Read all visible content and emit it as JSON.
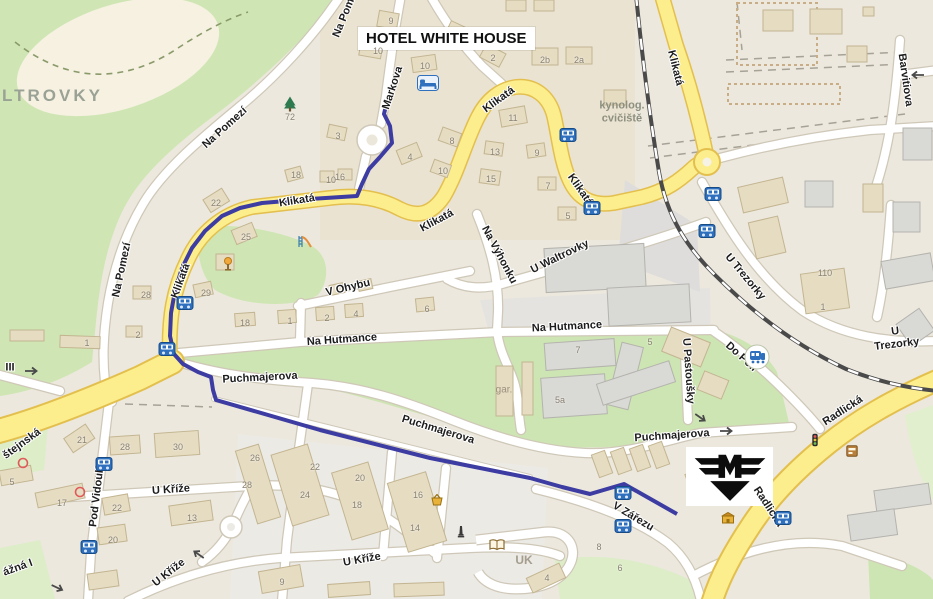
{
  "hotel": {
    "label": "HOTEL WHITE HOUSE"
  },
  "district_label": "LTROVKY",
  "logo": {
    "letter": "M",
    "name": "m-company-logo"
  },
  "colors": {
    "route": "#3c3ca2",
    "main_road_fill": "#fcee8d",
    "main_road_casing": "#e3bf4e",
    "minor_road_fill": "#ffffff",
    "minor_road_casing": "#cfc8b8",
    "green_area": "#cde5b2",
    "pale_green": "#dcedc8",
    "building_tan": "#e6dcc2",
    "building_gray": "#dbdad5",
    "railway_dark": "#4a4a4a",
    "bus_icon_blue": "#2e6fbe",
    "background": "#ece8dd"
  },
  "route": {
    "color": "#3c3ca2",
    "points": [
      [
        388,
        97
      ],
      [
        384,
        114
      ],
      [
        390,
        126
      ],
      [
        392,
        143
      ],
      [
        380,
        157
      ],
      [
        369,
        169
      ],
      [
        362,
        184
      ],
      [
        357,
        196
      ],
      [
        310,
        199
      ],
      [
        262,
        203
      ],
      [
        240,
        208
      ],
      [
        222,
        216
      ],
      [
        205,
        231
      ],
      [
        192,
        248
      ],
      [
        182,
        268
      ],
      [
        175,
        291
      ],
      [
        171,
        313
      ],
      [
        170,
        336
      ],
      [
        174,
        354
      ],
      [
        183,
        364
      ],
      [
        198,
        372
      ],
      [
        211,
        377
      ],
      [
        213,
        390
      ],
      [
        216,
        400
      ],
      [
        320,
        430
      ],
      [
        430,
        458
      ],
      [
        530,
        478
      ],
      [
        562,
        487
      ],
      [
        590,
        494
      ],
      [
        624,
        484
      ],
      [
        677,
        514
      ]
    ]
  },
  "street_labels": [
    {
      "t": "Na Pom",
      "x": 344,
      "y": 18,
      "rot": -68
    },
    {
      "t": "Na Pomezí",
      "x": 225,
      "y": 128,
      "rot": -42
    },
    {
      "t": "Na Pomezí",
      "x": 122,
      "y": 270,
      "rot": -78
    },
    {
      "t": "Markova",
      "x": 393,
      "y": 88,
      "rot": -72
    },
    {
      "t": "Klikatá",
      "x": 297,
      "y": 201,
      "rot": -9
    },
    {
      "t": "Klikatá",
      "x": 181,
      "y": 281,
      "rot": -70
    },
    {
      "t": "Klikatá",
      "x": 437,
      "y": 221,
      "rot": -28
    },
    {
      "t": "Klikatá",
      "x": 499,
      "y": 100,
      "rot": -36
    },
    {
      "t": "Klikatá",
      "x": 580,
      "y": 190,
      "rot": 55
    },
    {
      "t": "Klikatá",
      "x": 675,
      "y": 68,
      "rot": 76
    },
    {
      "t": "Na Výhonku",
      "x": 499,
      "y": 255,
      "rot": 62
    },
    {
      "t": "U Waltrovky",
      "x": 560,
      "y": 257,
      "rot": -26
    },
    {
      "t": "U Trezorky",
      "x": 745,
      "y": 277,
      "rot": 50
    },
    {
      "t": "U Trezorky",
      "x": 896,
      "y": 338,
      "rot": -7
    },
    {
      "t": "Barvitiova",
      "x": 905,
      "y": 80,
      "rot": 82
    },
    {
      "t": "Na Hutmance",
      "x": 342,
      "y": 340,
      "rot": -4
    },
    {
      "t": "Na Hutmance",
      "x": 567,
      "y": 327,
      "rot": -3
    },
    {
      "t": "V Ohybu",
      "x": 348,
      "y": 288,
      "rot": -13
    },
    {
      "t": "U Pastoušky",
      "x": 688,
      "y": 371,
      "rot": 86
    },
    {
      "t": "Do Polí",
      "x": 741,
      "y": 357,
      "rot": 42
    },
    {
      "t": "Puchmajerova",
      "x": 260,
      "y": 378,
      "rot": -3
    },
    {
      "t": "Puchmajerova",
      "x": 438,
      "y": 430,
      "rot": 17
    },
    {
      "t": "Puchmajerova",
      "x": 672,
      "y": 436,
      "rot": -4
    },
    {
      "t": "Radlická",
      "x": 843,
      "y": 411,
      "rot": -33
    },
    {
      "t": "Radlická",
      "x": 768,
      "y": 507,
      "rot": 57
    },
    {
      "t": "V Zářezu",
      "x": 633,
      "y": 517,
      "rot": 31
    },
    {
      "t": "U Kříže",
      "x": 171,
      "y": 490,
      "rot": -4
    },
    {
      "t": "U Kříže",
      "x": 169,
      "y": 573,
      "rot": -38
    },
    {
      "t": "U Kříže",
      "x": 362,
      "y": 560,
      "rot": -10
    },
    {
      "t": "Pod Vidoulí",
      "x": 97,
      "y": 497,
      "rot": -83
    },
    {
      "t": "štejnská",
      "x": 22,
      "y": 444,
      "rot": -36
    },
    {
      "t": "III",
      "x": 10,
      "y": 368,
      "rot": 0
    },
    {
      "t": "ážná I",
      "x": 18,
      "y": 568,
      "rot": -20
    },
    {
      "t": "kynolog.\ncvičiště",
      "x": 622,
      "y": 112,
      "rot": 0,
      "cls": "area"
    },
    {
      "t": "UK",
      "x": 524,
      "y": 561,
      "rot": 0,
      "cls": "area-bold"
    },
    {
      "t": "gar.",
      "x": 504,
      "y": 390,
      "rot": 0,
      "cls": "small-gray"
    }
  ],
  "house_numbers": [
    {
      "t": "9",
      "x": 391,
      "y": 21
    },
    {
      "t": "10",
      "x": 378,
      "y": 51
    },
    {
      "t": "10",
      "x": 425,
      "y": 66
    },
    {
      "t": "2",
      "x": 493,
      "y": 58
    },
    {
      "t": "2b",
      "x": 545,
      "y": 60
    },
    {
      "t": "2a",
      "x": 579,
      "y": 60
    },
    {
      "t": "11",
      "x": 513,
      "y": 118
    },
    {
      "t": "3",
      "x": 338,
      "y": 136
    },
    {
      "t": "8",
      "x": 452,
      "y": 141
    },
    {
      "t": "4",
      "x": 410,
      "y": 157
    },
    {
      "t": "10",
      "x": 443,
      "y": 171
    },
    {
      "t": "13",
      "x": 495,
      "y": 152
    },
    {
      "t": "9",
      "x": 537,
      "y": 153
    },
    {
      "t": "15",
      "x": 491,
      "y": 179
    },
    {
      "t": "7",
      "x": 548,
      "y": 186
    },
    {
      "t": "5",
      "x": 568,
      "y": 216
    },
    {
      "t": "10",
      "x": 331,
      "y": 180
    },
    {
      "t": "16",
      "x": 340,
      "y": 177
    },
    {
      "t": "18",
      "x": 296,
      "y": 175
    },
    {
      "t": "22",
      "x": 216,
      "y": 203
    },
    {
      "t": "25",
      "x": 246,
      "y": 237
    },
    {
      "t": "29",
      "x": 206,
      "y": 293
    },
    {
      "t": "28",
      "x": 146,
      "y": 295
    },
    {
      "t": "2",
      "x": 138,
      "y": 335
    },
    {
      "t": "18",
      "x": 245,
      "y": 323
    },
    {
      "t": "1",
      "x": 290,
      "y": 321
    },
    {
      "t": "2",
      "x": 327,
      "y": 318
    },
    {
      "t": "4",
      "x": 356,
      "y": 314
    },
    {
      "t": "6",
      "x": 427,
      "y": 309
    },
    {
      "t": "72",
      "x": 290,
      "y": 117
    },
    {
      "t": "110",
      "x": 825,
      "y": 273
    },
    {
      "t": "1",
      "x": 823,
      "y": 307
    },
    {
      "t": "7",
      "x": 578,
      "y": 350
    },
    {
      "t": "5a",
      "x": 560,
      "y": 400
    },
    {
      "t": "5",
      "x": 650,
      "y": 342
    },
    {
      "t": "1",
      "x": 87,
      "y": 343
    },
    {
      "t": "21",
      "x": 82,
      "y": 440
    },
    {
      "t": "5",
      "x": 12,
      "y": 482
    },
    {
      "t": "17",
      "x": 62,
      "y": 503
    },
    {
      "t": "28",
      "x": 125,
      "y": 447
    },
    {
      "t": "30",
      "x": 178,
      "y": 447
    },
    {
      "t": "28",
      "x": 247,
      "y": 485
    },
    {
      "t": "22",
      "x": 117,
      "y": 508
    },
    {
      "t": "20",
      "x": 113,
      "y": 540
    },
    {
      "t": "13",
      "x": 192,
      "y": 518
    },
    {
      "t": "26",
      "x": 255,
      "y": 458
    },
    {
      "t": "22",
      "x": 315,
      "y": 467
    },
    {
      "t": "24",
      "x": 305,
      "y": 495
    },
    {
      "t": "20",
      "x": 360,
      "y": 478
    },
    {
      "t": "18",
      "x": 357,
      "y": 505
    },
    {
      "t": "16",
      "x": 418,
      "y": 495
    },
    {
      "t": "14",
      "x": 415,
      "y": 528
    },
    {
      "t": "9",
      "x": 282,
      "y": 582
    },
    {
      "t": "4",
      "x": 547,
      "y": 578
    },
    {
      "t": "8",
      "x": 599,
      "y": 547
    },
    {
      "t": "6",
      "x": 620,
      "y": 568
    }
  ],
  "icons": [
    {
      "type": "bed",
      "x": 428,
      "y": 83
    },
    {
      "type": "bus",
      "x": 568,
      "y": 135
    },
    {
      "type": "bus",
      "x": 592,
      "y": 208
    },
    {
      "type": "bus",
      "x": 713,
      "y": 194
    },
    {
      "type": "bus",
      "x": 707,
      "y": 231
    },
    {
      "type": "bus",
      "x": 185,
      "y": 303
    },
    {
      "type": "bus",
      "x": 167,
      "y": 349
    },
    {
      "type": "bus",
      "x": 104,
      "y": 464
    },
    {
      "type": "bus",
      "x": 89,
      "y": 547
    },
    {
      "type": "bus",
      "x": 623,
      "y": 493
    },
    {
      "type": "bus",
      "x": 623,
      "y": 526
    },
    {
      "type": "bus",
      "x": 783,
      "y": 518
    },
    {
      "type": "train-station",
      "x": 757,
      "y": 357
    },
    {
      "type": "playground",
      "x": 305,
      "y": 242
    },
    {
      "type": "lamp",
      "x": 228,
      "y": 264
    },
    {
      "type": "tree",
      "x": 290,
      "y": 104
    },
    {
      "type": "basket",
      "x": 437,
      "y": 500
    },
    {
      "type": "book",
      "x": 497,
      "y": 545
    },
    {
      "type": "monument",
      "x": 461,
      "y": 532
    },
    {
      "type": "shop",
      "x": 728,
      "y": 518
    },
    {
      "type": "atm",
      "x": 852,
      "y": 451
    },
    {
      "type": "traffic-light",
      "x": 815,
      "y": 440
    },
    {
      "type": "red-ring",
      "x": 23,
      "y": 463
    },
    {
      "type": "red-ring",
      "x": 80,
      "y": 492
    },
    {
      "type": "arrow",
      "x": 32,
      "y": 371,
      "rot": 0
    },
    {
      "type": "arrow",
      "x": 727,
      "y": 431,
      "rot": 0
    },
    {
      "type": "arrow",
      "x": 917,
      "y": 75,
      "rot": 180
    },
    {
      "type": "arrow",
      "x": 198,
      "y": 554,
      "rot": 215
    },
    {
      "type": "arrow",
      "x": 58,
      "y": 588,
      "rot": 25
    },
    {
      "type": "arrow",
      "x": 701,
      "y": 418,
      "rot": 35
    }
  ]
}
